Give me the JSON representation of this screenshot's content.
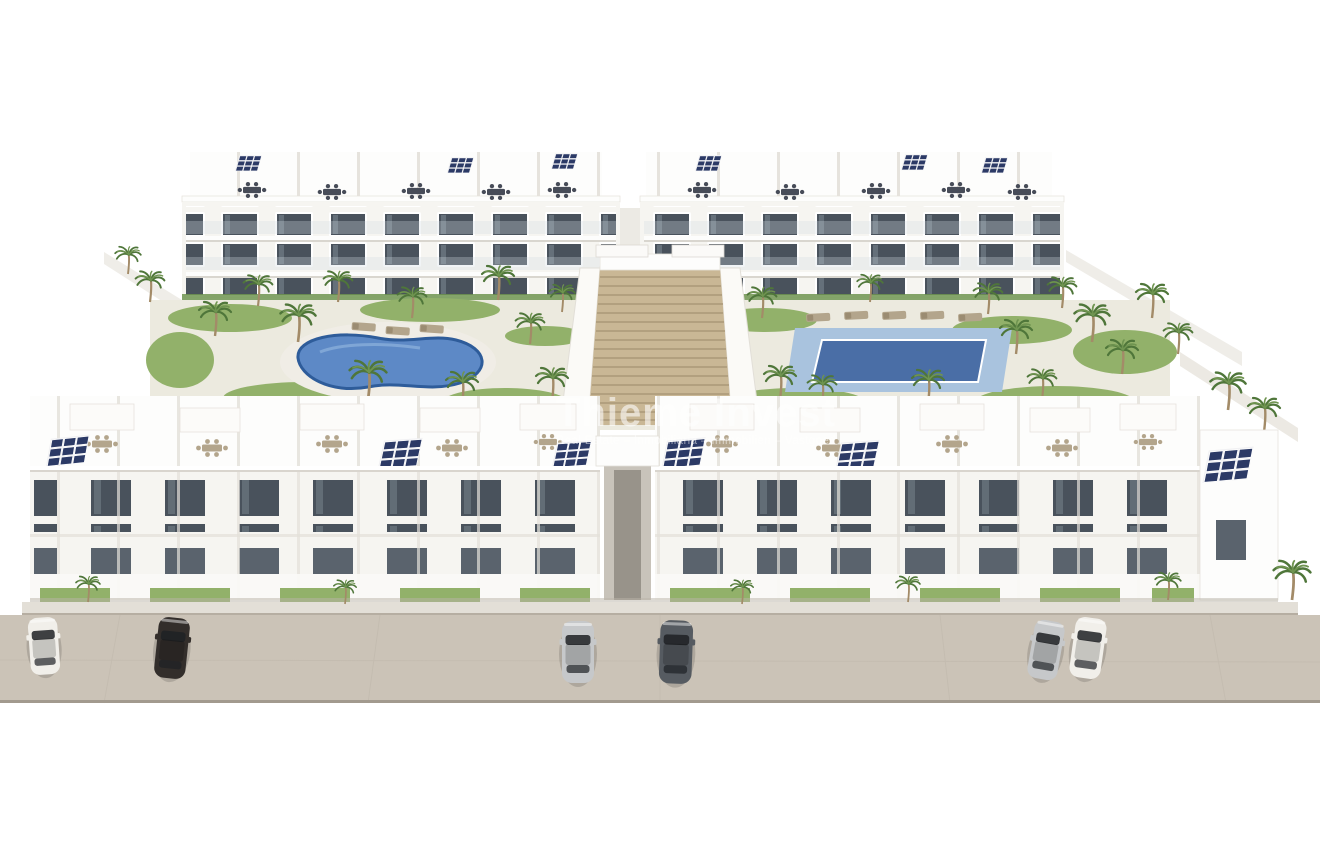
{
  "watermark": {
    "title": "Thieme Invest",
    "subtitle": "Real Estate – Inmobiliaria – Immobilien – Vastgoed"
  },
  "scene": {
    "type": "architectural-3d-rendering",
    "description": "Aerial render of a white Mediterranean apartment complex: two rear blocks, two front blocks, kidney pool (left), rectangular pool (right), central garden staircase, rooftop terraces with solar panels, palm trees, six parked cars on the street",
    "apartment_blocks": 4,
    "pools": [
      {
        "position": "left",
        "shape": "kidney"
      },
      {
        "position": "right",
        "shape": "rectangular"
      }
    ],
    "cars": [
      {
        "color": "white"
      },
      {
        "color": "dark-brown"
      },
      {
        "color": "silver"
      },
      {
        "color": "dark-gray"
      },
      {
        "color": "silver"
      },
      {
        "color": "white-with-black-roof"
      }
    ],
    "has_solar_panels": true,
    "has_palm_trees": true
  },
  "colors": {
    "wall": "#f6f5f1",
    "wall-bright": "#fdfdfc",
    "wall-shade": "#e6e3dd",
    "wall-dark": "#cfcbc3",
    "glass": "#49525c",
    "glass-low": "#5a636d",
    "balcony": "#cfdbe2",
    "green": "#6f9450",
    "green-dark": "#4f763a",
    "green-light": "#92b16a",
    "trunk": "#a38b68",
    "pool-left": "#5d89c6",
    "pool-rim": "#2e5c9a",
    "pool-right": "#4a6ea6",
    "pool-deck": "#a9c3de",
    "stairs": "#c9b795",
    "stair-line": "#ab9878",
    "road": "#cbc3b7",
    "road-edge": "#a29a8e",
    "sidewalk": "#e3dfd7",
    "solar": "#2c3a66",
    "furn": "#b3a58c",
    "furn-dark": "#474c58",
    "car-white": "#f1efea",
    "car-black": "#332e2b",
    "car-silver": "#c6c8ca",
    "car-gray": "#565b61",
    "car-glass": "#1e2125"
  }
}
